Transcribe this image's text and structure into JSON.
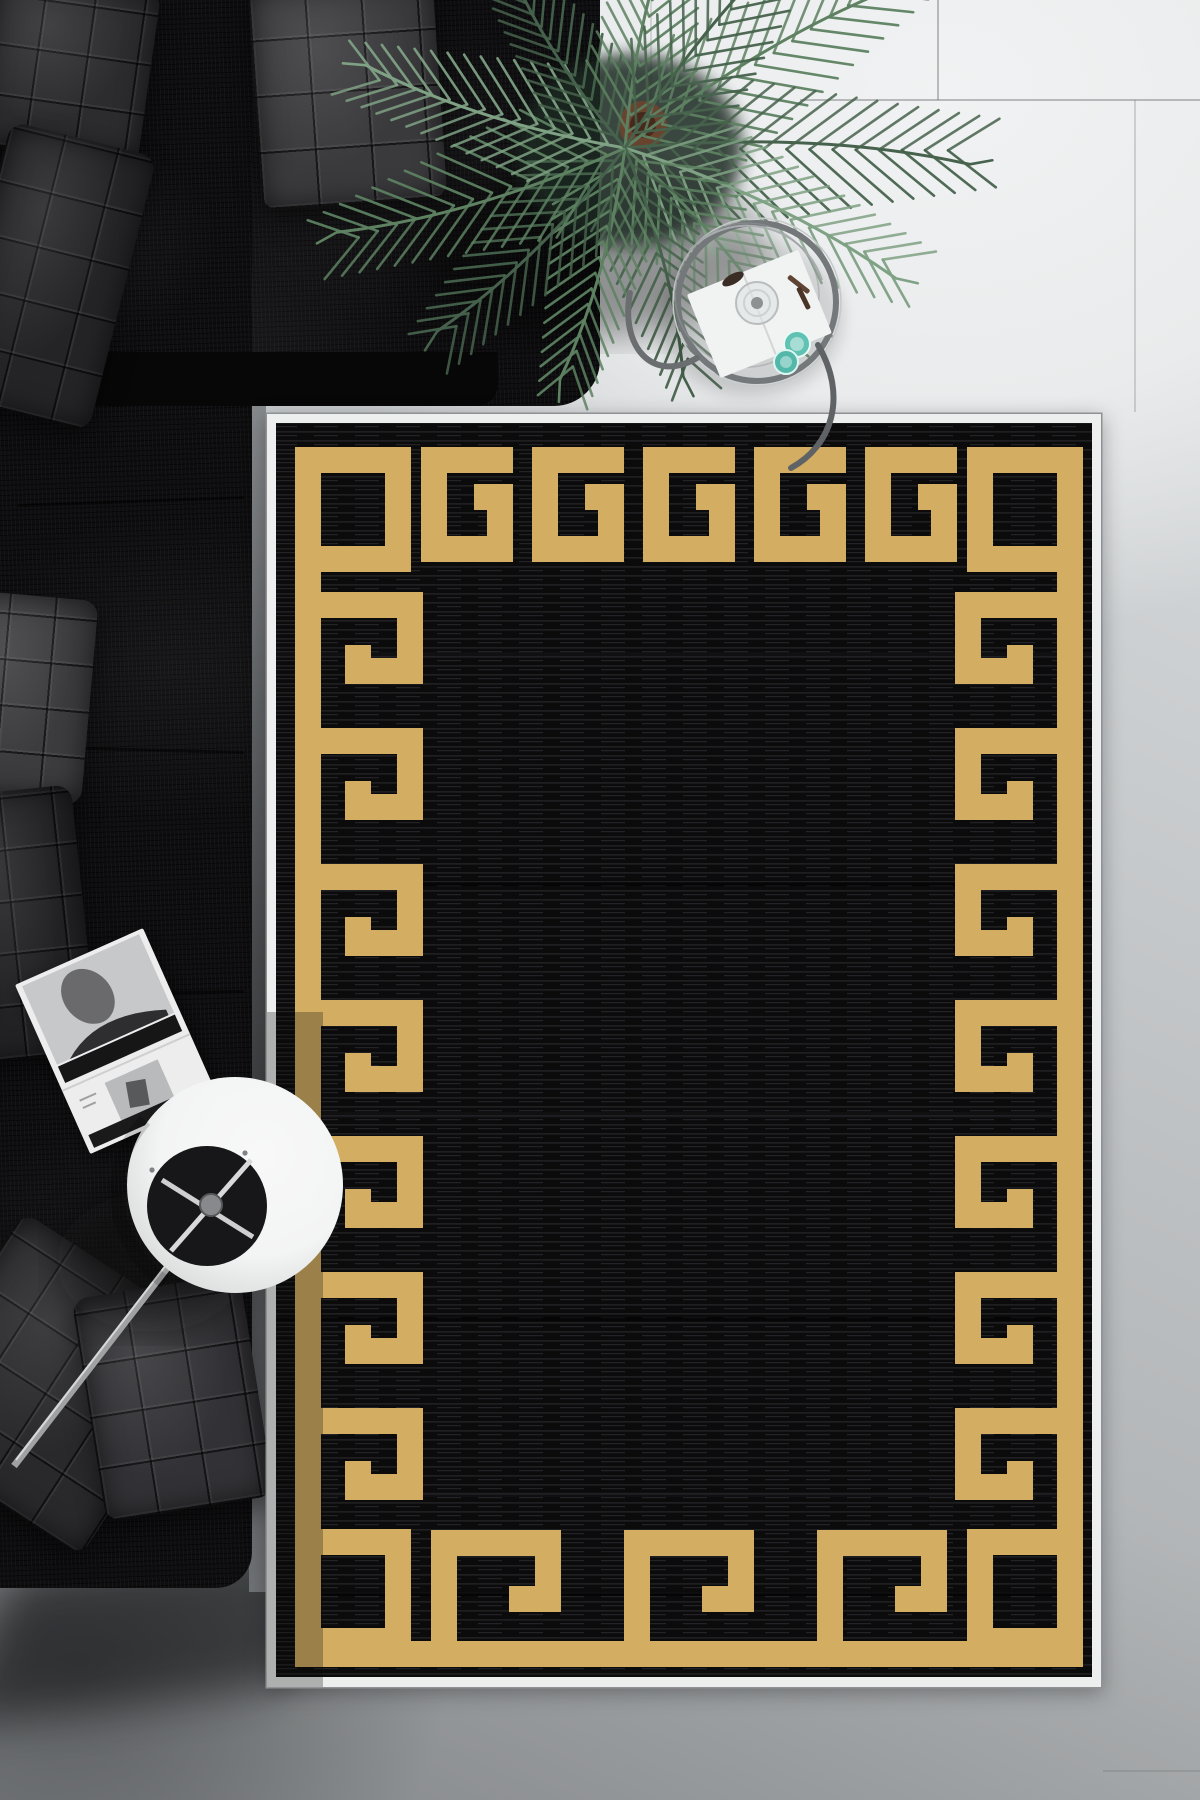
{
  "scene": {
    "type": "top-down interior photograph",
    "description": "Black area rug with gold Greek-key meander border and thin white fringe edge, laid on light gray tile floor beside a black chenille sectional sofa with quilted cushions; green palm plant, round metal-framed glass side table with white book, glass decanter and two teal glasses; white cylinder floor lamp seen from above with metal rod; open black-and-white magazine on the chaise."
  },
  "palette": {
    "floor_light": "#f1f2f3",
    "floor_mid": "#bcbfc1",
    "floor_dark": "#9b9ea1",
    "sofa_black": "#0e0e10",
    "sofa_edge": "#070708",
    "pillow_gray_light": "#3a3a3d",
    "pillow_gray": "#2c2c2f",
    "pillow_gray_dark": "#242427",
    "rug_black": "#0b0b0c",
    "rug_streak": "#1f1f22",
    "rug_gold": "#d3ae62",
    "rug_edge_white": "#edefef",
    "leaf_dark": "#46624c",
    "leaf_mid": "#5d8161",
    "leaf_light": "#7fa184",
    "teal": "#5fc2b2",
    "lamp_white": "#f3f4f4",
    "lamp_hole": "#17171a",
    "metal": "#85888a",
    "metal_dark": "#63666 8",
    "book_white": "#f1f2f2",
    "photo_gray": "#c7c8c9",
    "photo_dark": "#2e2e30",
    "pot_brown": "#6e452f"
  },
  "objects": [
    {
      "id": "rug",
      "label": "black and gold greek key rug"
    },
    {
      "id": "rug-border",
      "label": "gold meander border"
    },
    {
      "id": "sofa",
      "label": "black sectional sofa"
    },
    {
      "id": "palm-plant",
      "label": "areca palm plant"
    },
    {
      "id": "side-table",
      "label": "round glass side table"
    },
    {
      "id": "decanter",
      "label": "glass decanter"
    },
    {
      "id": "teal-glasses",
      "label": "two teal glasses"
    },
    {
      "id": "book",
      "label": "white open book on table"
    },
    {
      "id": "floor-lamp",
      "label": "white drum floor lamp from above"
    },
    {
      "id": "magazine",
      "label": "open black and white magazine"
    },
    {
      "id": "floor",
      "label": "light gray tile floor"
    }
  ],
  "plant": {
    "cx": 625,
    "cy": 148,
    "fronds": [
      {
        "angle": -28,
        "len": 330,
        "color": "leaf_mid"
      },
      {
        "angle": 5,
        "len": 345,
        "color": "leaf_dark"
      },
      {
        "angle": 28,
        "len": 300,
        "color": "leaf_light"
      },
      {
        "angle": 52,
        "len": 255,
        "color": "leaf_mid"
      },
      {
        "angle": 78,
        "len": 235,
        "color": "leaf_dark"
      },
      {
        "angle": 108,
        "len": 240,
        "color": "leaf_mid"
      },
      {
        "angle": 138,
        "len": 262,
        "color": "leaf_dark"
      },
      {
        "angle": 166,
        "len": 300,
        "color": "leaf_mid"
      },
      {
        "angle": -160,
        "len": 272,
        "color": "leaf_light"
      },
      {
        "angle": -120,
        "len": 220,
        "color": "leaf_dark"
      },
      {
        "angle": -75,
        "len": 250,
        "color": "leaf_mid"
      },
      {
        "angle": -48,
        "len": 290,
        "color": "leaf_dark"
      }
    ]
  }
}
